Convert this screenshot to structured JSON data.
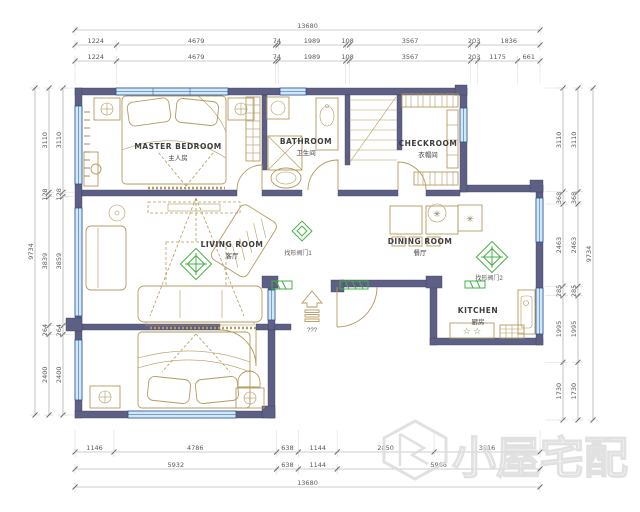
{
  "watermark": {
    "text": "小屋宅配"
  },
  "entry": {
    "label": "???"
  },
  "rooms": [
    {
      "id": "master-bedroom",
      "name": "MASTER BEDROOM",
      "cn": "主人房"
    },
    {
      "id": "bathroom",
      "name": "BATHROOM",
      "cn": "卫生间"
    },
    {
      "id": "checkroom",
      "name": "CHECKROOM",
      "cn": "衣帽间"
    },
    {
      "id": "living-room",
      "name": "LIVING ROOM",
      "cn": "客厅"
    },
    {
      "id": "dining-room",
      "name": "DINING ROOM",
      "cn": "餐厅"
    },
    {
      "id": "kitchen",
      "name": "KITCHEN",
      "cn": "厨房"
    }
  ],
  "door_labels": [
    {
      "text": "找形阀门1"
    },
    {
      "text": "找形阀门2"
    }
  ],
  "icons": {
    "burner_icon": "☆ ☆",
    "flower_icon": "✳"
  },
  "dimensions": {
    "top": {
      "overall": "13680",
      "row1": [
        "1224",
        "4679",
        "74",
        "1989",
        "108",
        "3567",
        "203",
        "1836"
      ],
      "row2": [
        "1224",
        "4679",
        "74",
        "1989",
        "108",
        "3567",
        "203",
        "1175",
        "661"
      ]
    },
    "bottom": {
      "overall": "13680",
      "row1": [
        "1146",
        "4786",
        "638",
        "1144",
        "2850",
        "3116"
      ],
      "row2": [
        "5932",
        "638",
        "1144",
        "5966"
      ]
    },
    "left": {
      "overall": "9734",
      "row1": [
        "3110",
        "128",
        "3839",
        "264",
        "2400"
      ],
      "row2": [
        "3110",
        "128",
        "3859",
        "264",
        "2400"
      ]
    },
    "right": {
      "overall": "9734",
      "row1": [
        "3110",
        "368",
        "2463",
        "285",
        "1995",
        "1730"
      ],
      "row2": [
        "3110",
        "368",
        "2463",
        "285",
        "1995",
        "1730"
      ]
    }
  },
  "colors": {
    "wall": "#5d6084",
    "window": "#cfe9f6",
    "window_frame": "#2e4e9e",
    "furniture": "#b59a5e",
    "accent_green": "#44b044",
    "dimension_text": "#5a5a5a",
    "watermark": "#dedede"
  }
}
